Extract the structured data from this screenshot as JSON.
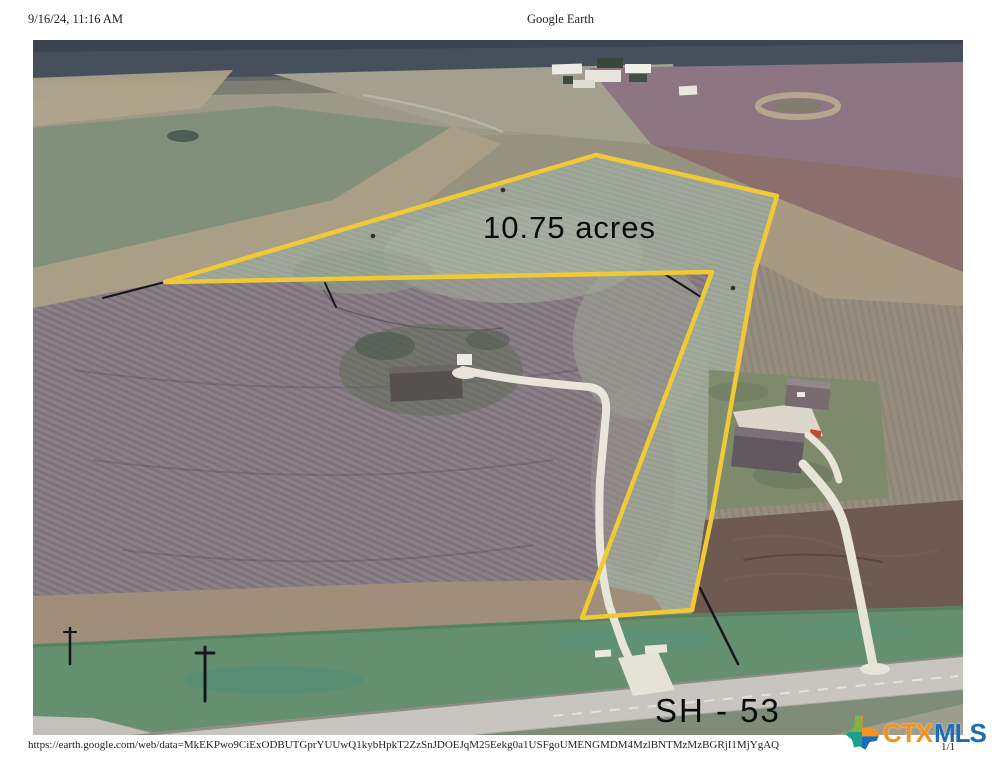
{
  "header": {
    "datetime": "9/16/24, 11:16 AM",
    "title": "Google Earth"
  },
  "map": {
    "parcel_label": "10.75 acres",
    "road_label": "SH - 53",
    "polygon_color": "#f0c937"
  },
  "footer": {
    "url": "https://earth.google.com/web/data=MkEKPwo9CiExODBUTGprYUUwQ1kybHpkT2ZzSnJDOEJqM25Eekg0a1USFgoUMENGMDM4MzlBNTMzMzBGRjI1MjYgAQ",
    "page": "1/1"
  },
  "logo": {
    "ctx": "CTX",
    "mls": "MLS",
    "ctx_color": "#f6911e",
    "mls_color": "#1e6cb5"
  }
}
